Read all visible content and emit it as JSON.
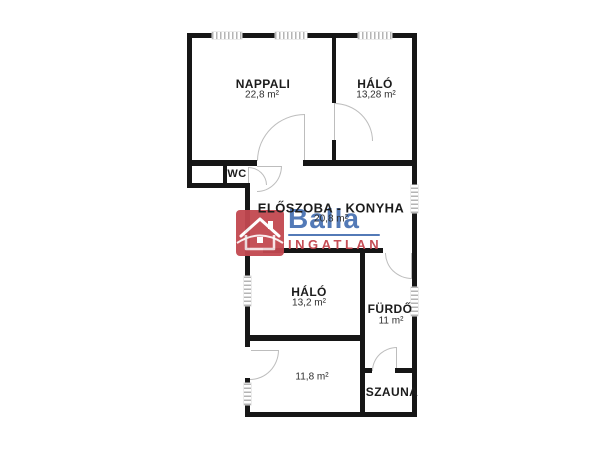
{
  "rooms": {
    "nappali": {
      "name": "NAPPALI",
      "area": "22,8 m²"
    },
    "halo_felso": {
      "name": "HÁLÓ",
      "area": "13,28 m²"
    },
    "wc": {
      "name": "WC"
    },
    "eloszoba_konyha": {
      "name": "ELŐSZOBA - KONYHA",
      "area": "20,8 m²"
    },
    "halo_also": {
      "name": "HÁLÓ",
      "area": "13,2 m²"
    },
    "furdo": {
      "name": "FÜRDŐ",
      "area": "11 m²"
    },
    "szoba": {
      "area": "11,8 m²"
    },
    "szauna": {
      "name": "SZAUNA"
    }
  },
  "watermark": {
    "brand": "Balla",
    "subtitle": "INGATLAN",
    "icon": "house-icon",
    "brand_color": "#4a73b4",
    "subtitle_color": "#c2454e",
    "icon_bg": "#c24850"
  },
  "colors": {
    "wall": "#161616",
    "window_hatch": "#b5b5b5",
    "door_arc": "#bdbdbd",
    "background": "#ffffff"
  }
}
